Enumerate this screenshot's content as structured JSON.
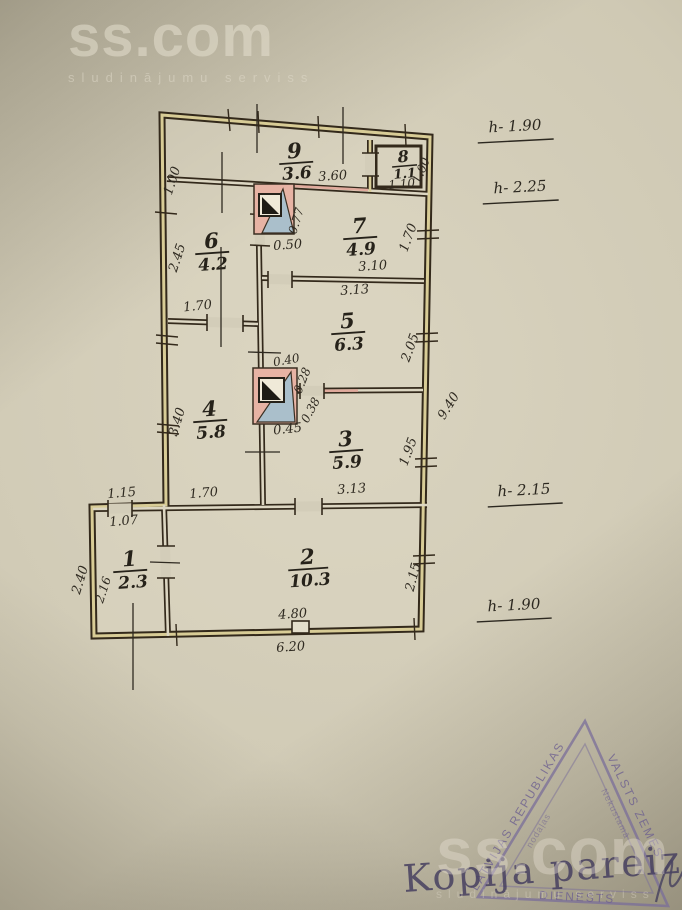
{
  "watermark": {
    "brand": "ss.com",
    "tagline": "sludinājumu serviss"
  },
  "plan": {
    "rooms": {
      "r1": {
        "num": "1",
        "area": "2.3"
      },
      "r2": {
        "num": "2",
        "area": "10.3"
      },
      "r3": {
        "num": "3",
        "area": "5.9"
      },
      "r4": {
        "num": "4",
        "area": "5.8"
      },
      "r5": {
        "num": "5",
        "area": "6.3"
      },
      "r6": {
        "num": "6",
        "area": "4.2"
      },
      "r7": {
        "num": "7",
        "area": "4.9"
      },
      "r8": {
        "num": "8",
        "area": "1.1"
      },
      "r9": {
        "num": "9",
        "area": "3.6"
      }
    },
    "dims": {
      "left_strip": "1.00",
      "r9_len": "3.60",
      "r8_w": "1.10",
      "r8_h": "1.00",
      "stove1_a": "0.77",
      "stove1_b": "0.50",
      "r6_h": "2.45",
      "r6_w": "1.70",
      "r7_len": "3.10",
      "r7_h": "1.70",
      "r5_top": "3.13",
      "r5_h": "2.05",
      "stove2_a": "0.40",
      "stove2_b": "0.28",
      "stove2_c": "0.38",
      "stove2_d": "0.45",
      "r4_h": "3.40",
      "r3_len": "3.13",
      "r3_h": "1.95",
      "depth": "9.40",
      "strip_a": "1.15",
      "strip_b": "1.70",
      "r1_w": "1.07",
      "r1_out": "2.40",
      "r1_h": "2.16",
      "r2_h": "2.15",
      "r2_len": "4.80",
      "total_w": "6.20"
    },
    "heights": {
      "h1": "h- 1.90",
      "h2": "h- 2.25",
      "h3": "h- 2.15",
      "h4": "h- 1.90"
    }
  },
  "stamp": {
    "copy": "Kopija pareiza",
    "tri_left": "LATVIJAS REPUBLIKAS",
    "tri_right": "VALSTS ZEMES",
    "tri_bottom": "DIENESTS",
    "tri_inner_left": "nodaļas",
    "tri_inner_right": "Nekustamā"
  },
  "colors": {
    "paper": "#cfc9b4",
    "ink": "#33291b",
    "wall_yellow": "#d8cc96",
    "chimney_pink": "#e7b3a4",
    "flue_blue": "#aabfcb",
    "stamp_purple": "#6e6190"
  }
}
